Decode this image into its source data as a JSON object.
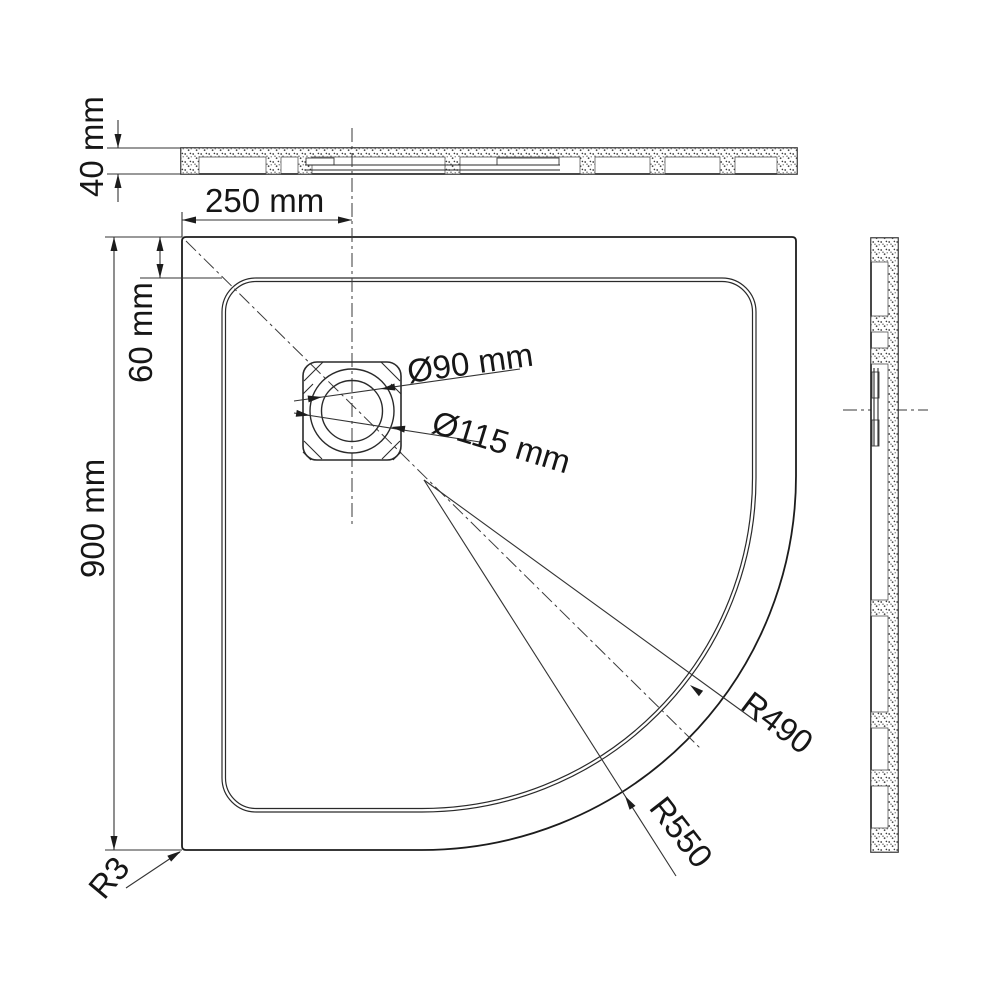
{
  "drawing": {
    "kind": "shower-tray-technical-drawing",
    "colors": {
      "line": "#1c1c1c",
      "background": "#ffffff"
    },
    "labels": {
      "dim40": "40 mm",
      "dim250": "250 mm",
      "dim60": "60 mm",
      "dim900": "900 mm",
      "dia90": "Ø90 mm",
      "dia115": "Ø115 mm",
      "r490": "R490",
      "r550": "R550",
      "r3": "R3"
    }
  }
}
